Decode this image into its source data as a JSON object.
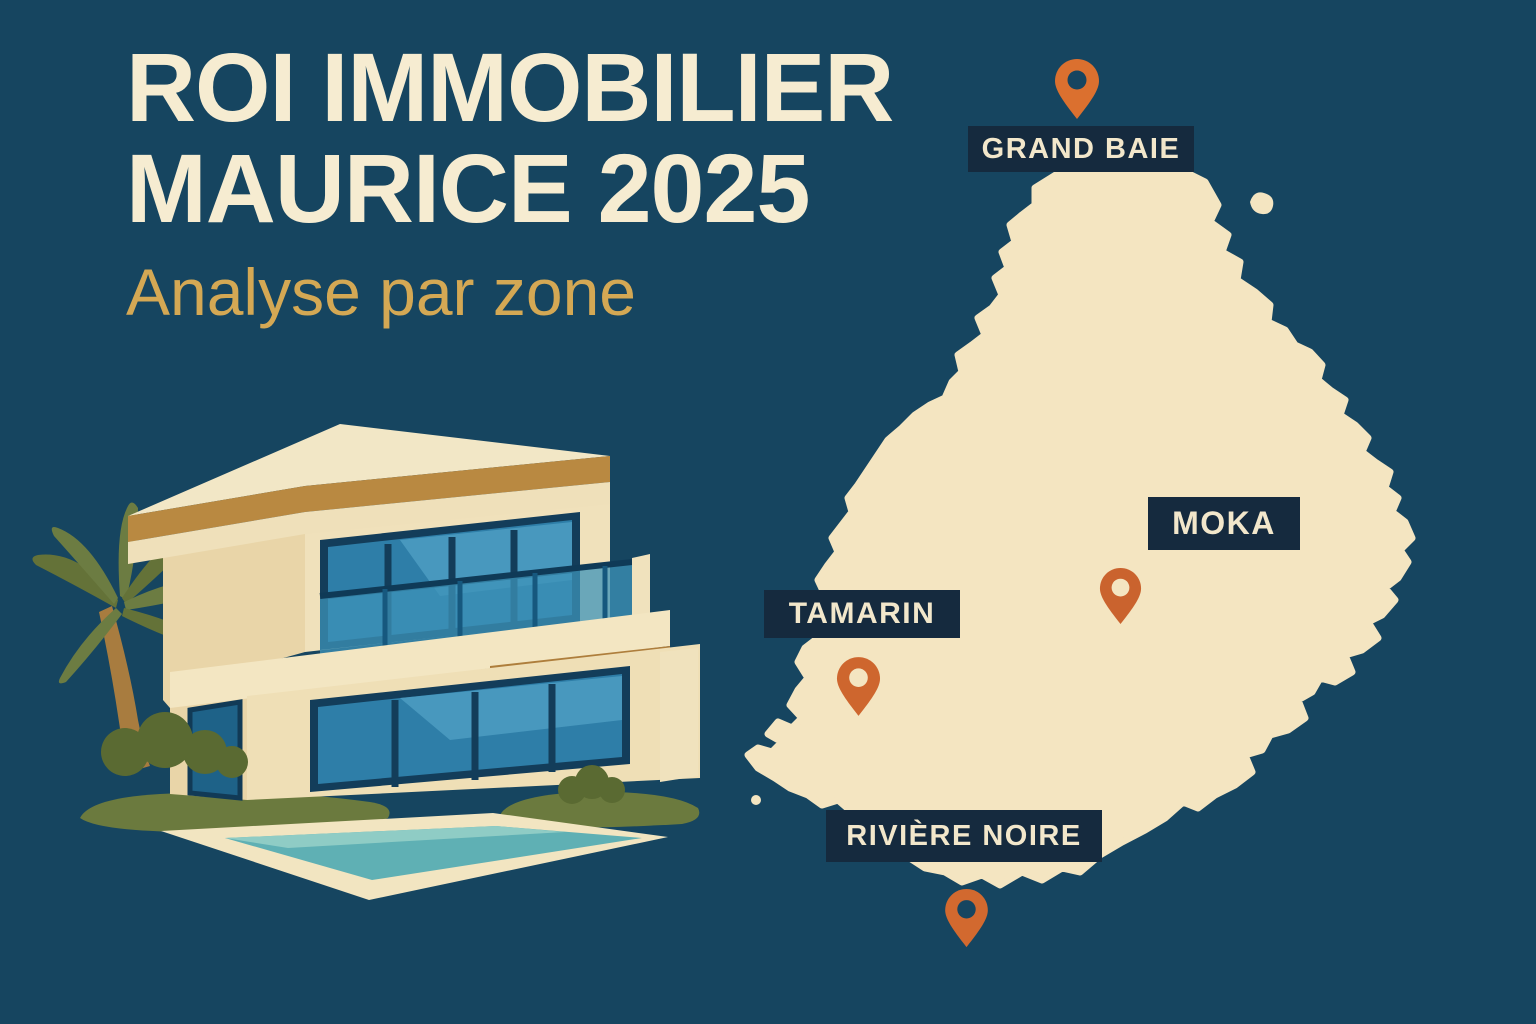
{
  "header": {
    "title_line1": "ROI IMMOBILIER",
    "title_line2": "MAURICE 2025",
    "subtitle": "Analyse par zone"
  },
  "colors": {
    "background": "#164560",
    "map_fill": "#F4E5C1",
    "label_bg": "#152A3E",
    "label_text": "#F2E7CB",
    "title": "#F6ECD1",
    "subtitle": "#D4A854",
    "pin_orange": "#D2692F"
  },
  "map": {
    "region": "Maurice",
    "locations": [
      {
        "id": "grand-baie",
        "label": "GRAND BAIE",
        "pin_color": "#DB702F",
        "pin_hole": "#164560"
      },
      {
        "id": "moka",
        "label": "MOKA",
        "pin_color": "#CA632E",
        "pin_hole": "#F4E5C1"
      },
      {
        "id": "tamarin",
        "label": "TAMARIN",
        "pin_color": "#CE662E",
        "pin_hole": "#F4E5C1"
      },
      {
        "id": "riviere-noire",
        "label": "RIVIÈRE NOIRE",
        "pin_color": "#D2692F",
        "pin_hole": "#164560"
      }
    ]
  },
  "illustration": {
    "subject": "modern-two-storey-villa-with-pool-and-palm-tree"
  }
}
